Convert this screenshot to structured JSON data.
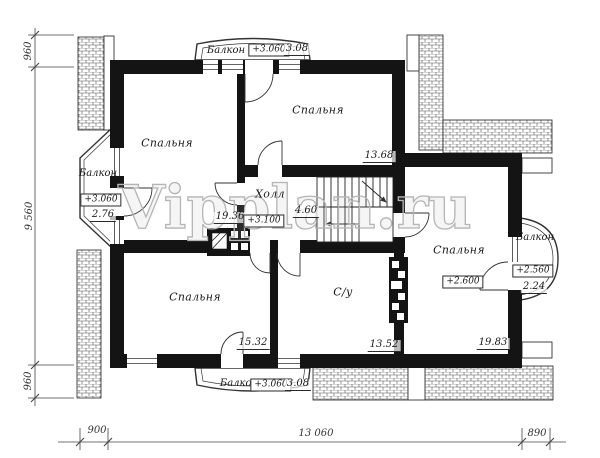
{
  "watermark": "Vipplan.ru",
  "rooms": {
    "bedroom_top_left": {
      "label": "Спальня",
      "area": "19.36"
    },
    "bedroom_top_center": {
      "label": "Спальня",
      "area": "13.68"
    },
    "hall": {
      "label": "Холл",
      "elevation": "+3.100",
      "stair_area": "4.60"
    },
    "bedroom_bottom_left": {
      "label": "Спальня",
      "area": "15.32"
    },
    "bathroom": {
      "label": "С/у",
      "area": "13.52"
    },
    "bedroom_right": {
      "label": "Спальня",
      "elevation": "+2.600",
      "area": "19.83"
    }
  },
  "balconies": {
    "top": {
      "label": "Балкон",
      "elevation": "+3.060",
      "area": "3.08"
    },
    "left": {
      "label": "Балкон",
      "elevation": "+3.060",
      "area": "2.76"
    },
    "bottom": {
      "label": "Балкон",
      "elevation": "+3.060",
      "area": "3.08"
    },
    "right": {
      "label": "Балкон",
      "elevation": "+2.560",
      "area": "2.24"
    }
  },
  "dimensions": {
    "left": [
      "960",
      "9 560",
      "960"
    ],
    "bottom": [
      "900",
      "13 060",
      "890"
    ]
  },
  "colors": {
    "wall": "#141414",
    "line": "#333333",
    "watermark": "#b5b5b5"
  }
}
